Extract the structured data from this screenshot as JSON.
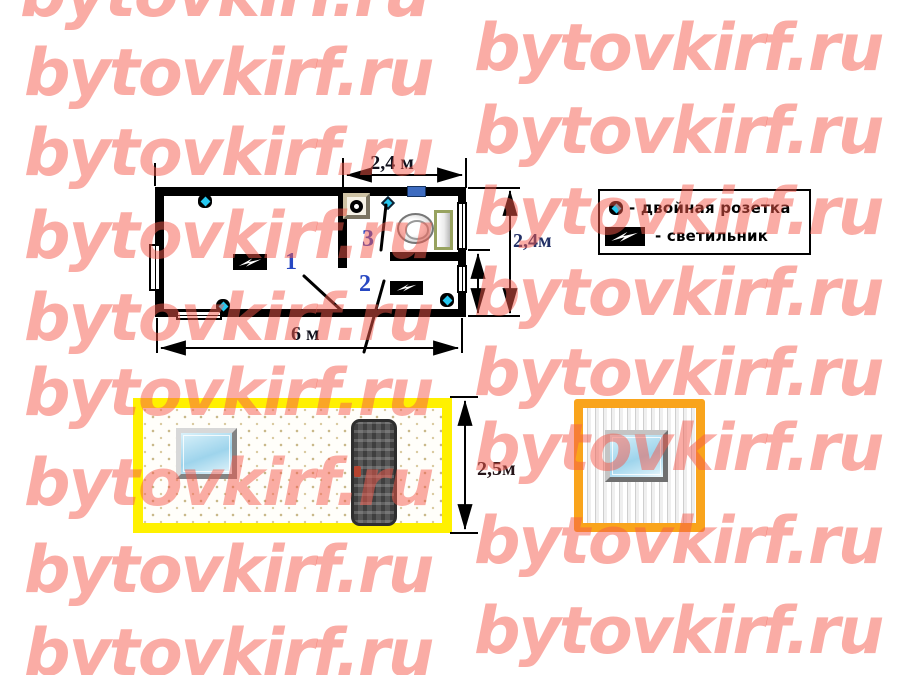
{
  "watermark": {
    "text": "bytovkirf.ru",
    "color": "#F65A4C"
  },
  "plan": {
    "dim_top": "2,4 м",
    "dim_right": "2,4м",
    "dim_bottom": "6 м",
    "rooms": [
      {
        "number": "1"
      },
      {
        "number": "2"
      },
      {
        "number": "3"
      }
    ]
  },
  "legend": {
    "items": [
      {
        "icon": "double-socket-icon",
        "label": "- двойная розетка"
      },
      {
        "icon": "light-icon",
        "label": "- светильник"
      }
    ]
  },
  "elevations": {
    "dim_height": "2,5м"
  },
  "colors": {
    "wall": "#000000",
    "socket_blue": "#25C8F0",
    "number_blue": "#2747C2",
    "yellow_frame": "#FFF100",
    "orange_frame": "#F9A41C",
    "plan_window_blue": "#3E6CC0"
  }
}
